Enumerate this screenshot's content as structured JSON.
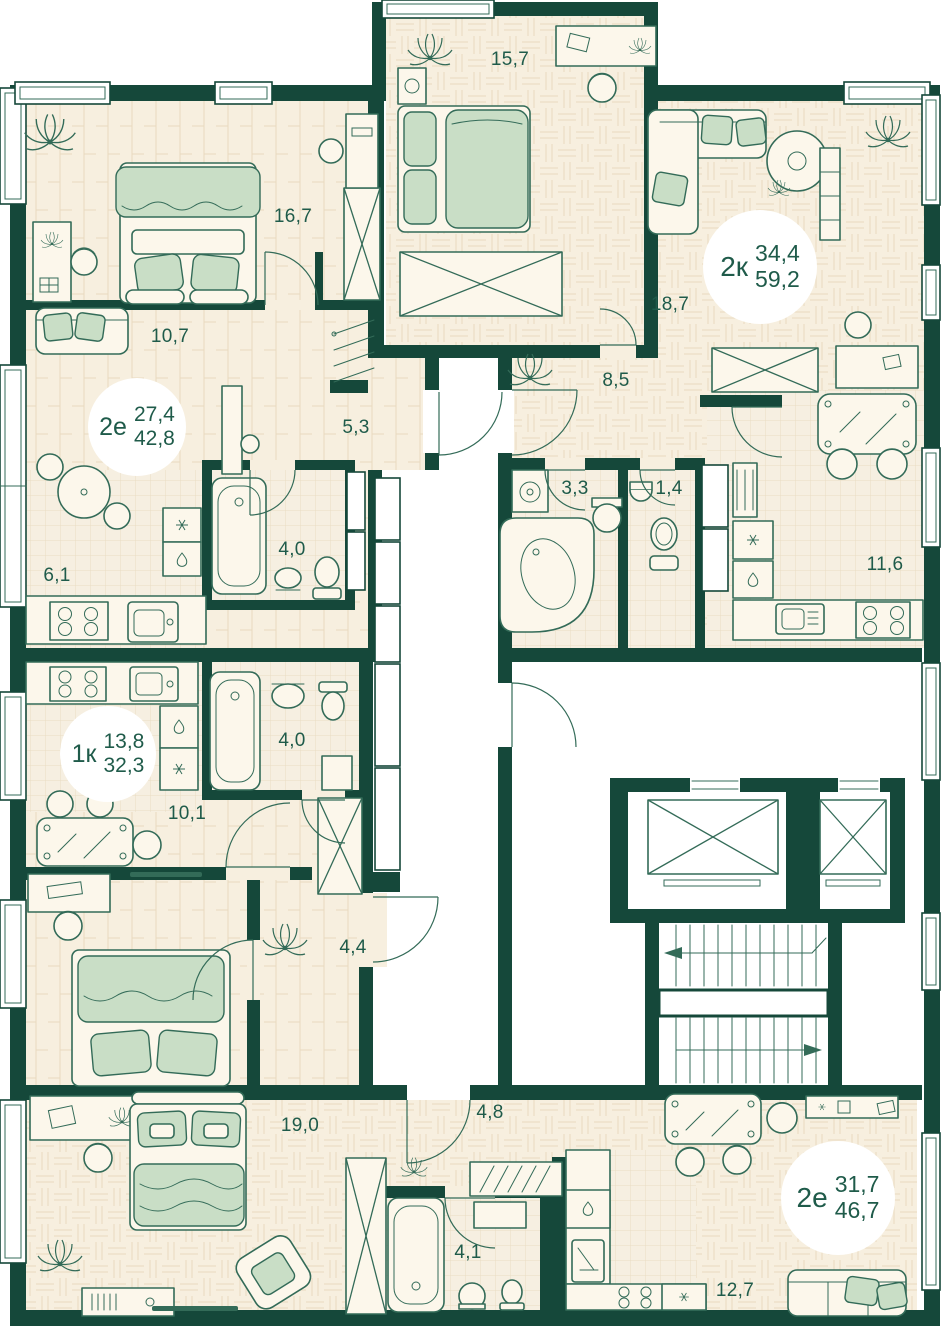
{
  "floor_plan": {
    "apartments": [
      {
        "type": "2е",
        "area_living": "27,4",
        "area_total": "42,8",
        "rooms": [
          {
            "area": "16,7"
          },
          {
            "area": "10,7"
          },
          {
            "area": "5,3"
          },
          {
            "area": "4,0"
          },
          {
            "area": "6,1"
          }
        ]
      },
      {
        "type": "2к",
        "area_living": "34,4",
        "area_total": "59,2",
        "rooms": [
          {
            "area": "15,7"
          },
          {
            "area": "18,7"
          },
          {
            "area": "8,5"
          },
          {
            "area": "3,3"
          },
          {
            "area": "1,4"
          },
          {
            "area": "11,6"
          }
        ]
      },
      {
        "type": "1к",
        "area_living": "13,8",
        "area_total": "32,3",
        "rooms": [
          {
            "area": "4,0"
          },
          {
            "area": "10,1"
          },
          {
            "area": "4,4"
          }
        ]
      },
      {
        "type": "2е",
        "area_living": "31,7",
        "area_total": "46,7",
        "rooms": [
          {
            "area": "19,0"
          },
          {
            "area": "4,8"
          },
          {
            "area": "4,1"
          },
          {
            "area": "12,7"
          }
        ]
      }
    ],
    "colors": {
      "wall": "#15483A",
      "floor": "#F7EFDF",
      "line": "#336B58",
      "soft": "#C9DEC6",
      "label": "#1F5B4A"
    }
  }
}
